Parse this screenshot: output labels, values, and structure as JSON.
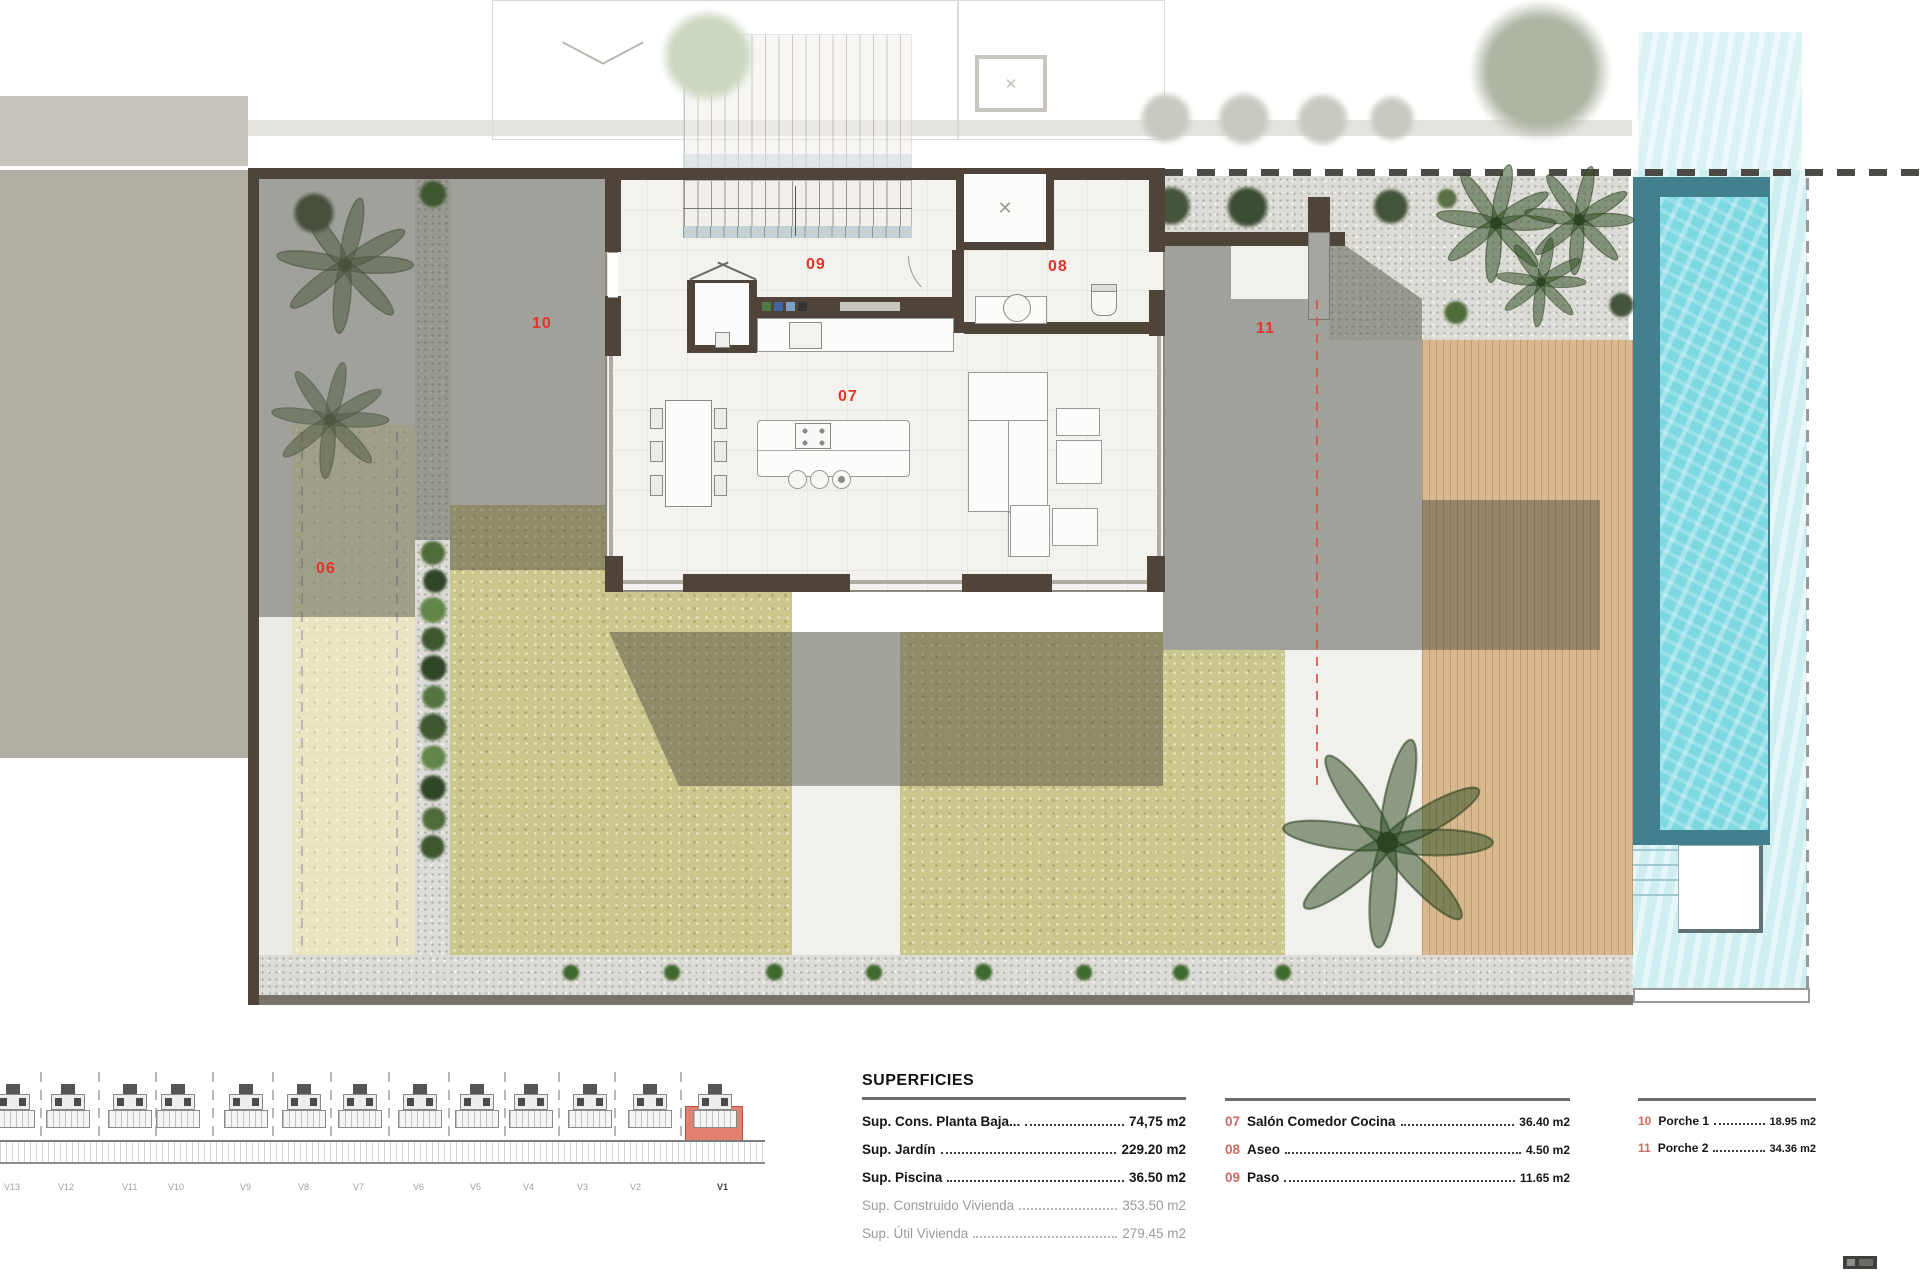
{
  "sheet": {
    "type": "floor-plan",
    "title": "SUPERFICIES"
  },
  "colors": {
    "room_label_red": "#e0352a",
    "legend_code_red": "#cf6a60",
    "wall_dark": "#50443a",
    "garden": "#cbc68c",
    "pool_water": "#7ed8e2",
    "deck_wood": "#d8b88e",
    "highlight_unit_red": "#e2816f"
  },
  "plan": {
    "room_labels": [
      {
        "code": "06",
        "x": 316,
        "y": 560
      },
      {
        "code": "07",
        "x": 838,
        "y": 388
      },
      {
        "code": "08",
        "x": 1048,
        "y": 258
      },
      {
        "code": "09",
        "x": 806,
        "y": 256
      },
      {
        "code": "10",
        "x": 532,
        "y": 315
      },
      {
        "code": "11",
        "x": 1256,
        "y": 320
      }
    ]
  },
  "legend": {
    "title": "SUPERFICIES",
    "left": [
      {
        "label": "Sup. Cons. Planta Baja...",
        "value": "74,75 m2",
        "muted": false
      },
      {
        "label": "Sup. Jardín",
        "value": "229.20 m2",
        "muted": false
      },
      {
        "label": "Sup. Piscina",
        "value": "36.50 m2",
        "muted": false
      },
      {
        "label": "Sup. Construido Vivienda",
        "value": "353.50 m2",
        "muted": true
      },
      {
        "label": "Sup. Útil Vivienda",
        "value": "279.45 m2",
        "muted": true
      }
    ],
    "middle": [
      {
        "code": "07",
        "label": "Salón Comedor Cocina",
        "value": "36.40 m2"
      },
      {
        "code": "08",
        "label": "Aseo",
        "value": "4.50 m2"
      },
      {
        "code": "09",
        "label": "Paso",
        "value": "11.65 m2"
      }
    ],
    "right": [
      {
        "code": "10",
        "label": "Porche 1",
        "value": "18.95 m2"
      },
      {
        "code": "11",
        "label": "Porche 2",
        "value": "34.36 m2"
      }
    ]
  },
  "elevation": {
    "units": [
      "V13",
      "V12",
      "V11",
      "V10",
      "V9",
      "V8",
      "V7",
      "V6",
      "V5",
      "V4",
      "V3",
      "V2",
      "V1"
    ],
    "highlighted_unit": "V1"
  }
}
